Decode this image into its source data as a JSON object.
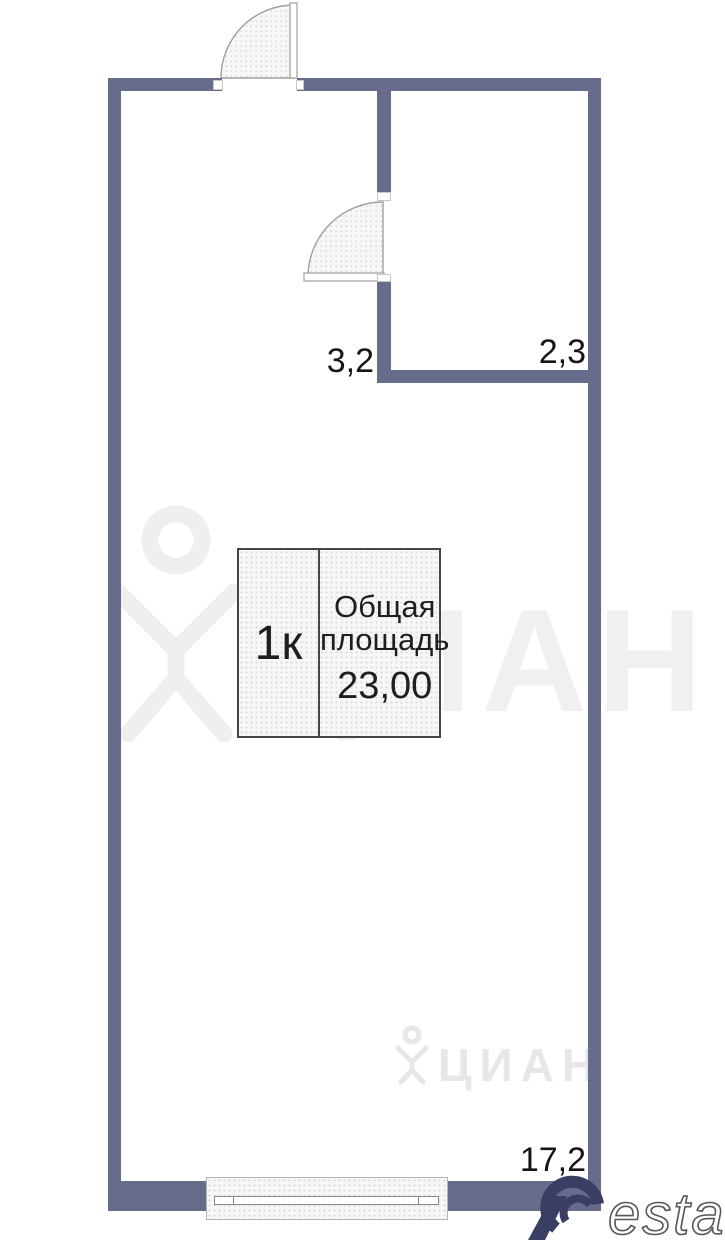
{
  "legend": {
    "room_type": "1к",
    "area_label_line1": "Общая",
    "area_label_line2": "площадь",
    "total_area": "23,00"
  },
  "rooms": {
    "hall_area": "3,2",
    "bathroom_area": "2,3",
    "living_area": "17,2"
  },
  "watermarks": {
    "brand_large": "ЦИАН",
    "brand_small": "ЦИАН",
    "restate_suffix": "estate"
  },
  "colors": {
    "wall": "#676b8c",
    "label_text": "#161616",
    "restate_navy": "#3a3e62",
    "watermark_gray": "#f0f0ee"
  }
}
